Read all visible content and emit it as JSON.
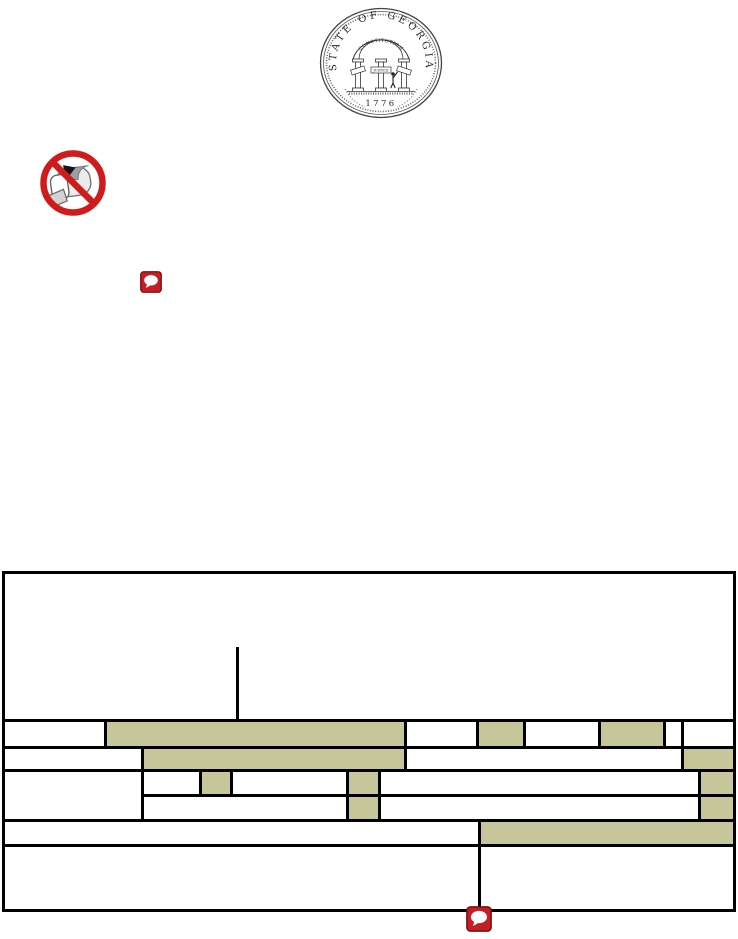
{
  "document": {
    "background": "#ffffff",
    "type_note": "scanned state form page"
  },
  "seal": {
    "ring_text": "STATE OF GEORGIA",
    "arch_text": "CONSTITUTION",
    "banner_text": "JUSTICE",
    "year": "1776"
  },
  "colors": {
    "highlight": "#c7c69b",
    "table_border": "#000000",
    "prohibition_red": "#cf1b1b",
    "comment_red": "#c51f24"
  },
  "icons": {
    "seal": "georgia-state-seal",
    "no_mail": "no-mail-prohibition-icon",
    "comment": "comment-annotation-icon"
  }
}
